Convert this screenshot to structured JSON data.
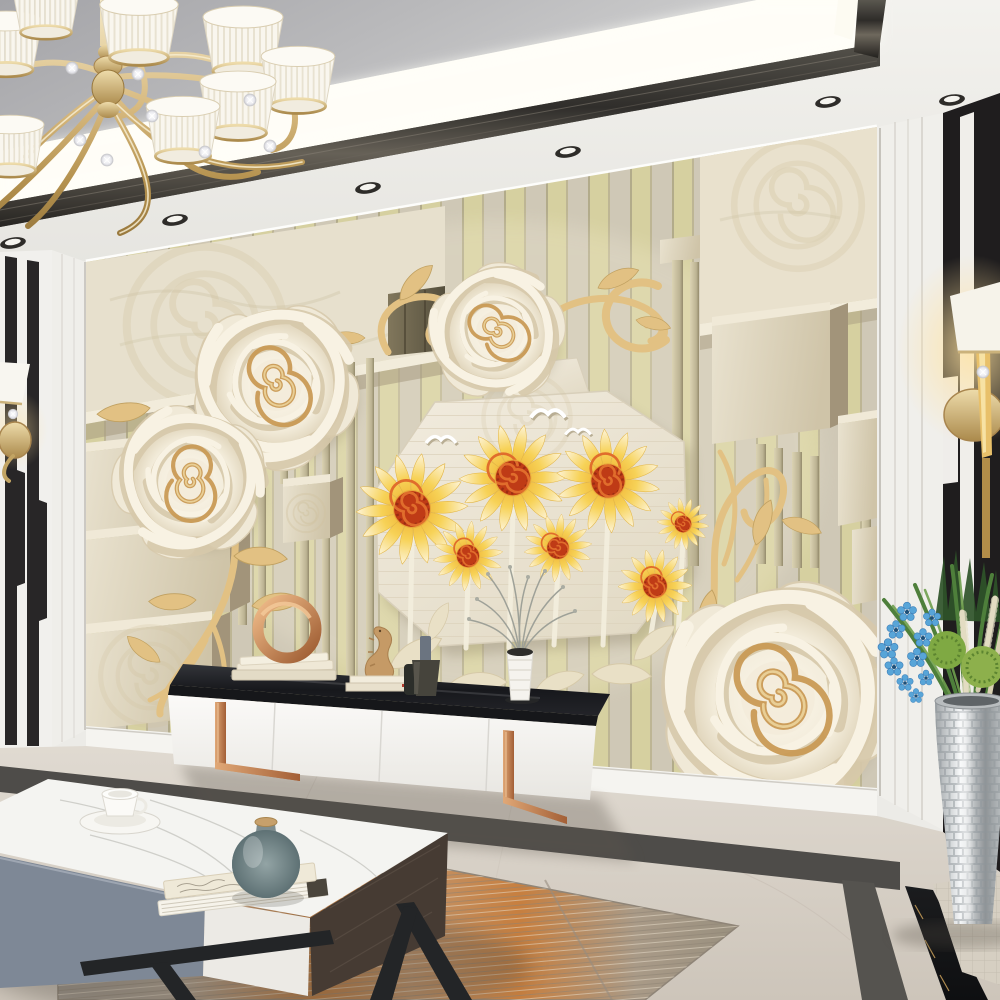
{
  "image": {
    "type": "interior-render",
    "subject": "Modern living room with 3D rose and sunflower embossed mural feature wall",
    "width_px": 1000,
    "height_px": 1000
  },
  "colors": {
    "ceiling_shadow": "#a7a7ab",
    "cove_white": "#fffdf7",
    "trim_dark": "#3a3835",
    "soffit": "#ecebe7",
    "wall_white": "#f2f1ed",
    "stripe_gold": "#d6d0a0",
    "stripe_beige": "#cfc8b6",
    "block_face": "#dcd2bc",
    "rose_petal": "#f4eedd",
    "rose_center": "#c99a55",
    "octagon": "#ece6d6",
    "sun_petal": "#f0b93a",
    "sun_petal_tip": "#fdf4d8",
    "sun_center": "#bf3b16",
    "sun_swirl": "#e06d2c",
    "gold_branch": "#e2c183",
    "gold_metal": "#d9bd8a",
    "black_panel": "#1f1d1e",
    "copper": "#c07f52",
    "console_white": "#f7f6f3",
    "floor_light": "#ddd7ce",
    "floor_dark": "#cfc7bc",
    "strip_gray": "#4e4c49",
    "marble_black": "#141517",
    "rug_orange": "#c07a3c",
    "rug_gray": "#a1988d",
    "table_front": "#7e8896",
    "wood_dark": "#463b33",
    "vase_teal": "#77898c",
    "plant_green": "#4e7f3b",
    "plant_blue": "#58a5d8",
    "silver": "#ccd0d2",
    "glow": "#ffdf9e"
  },
  "scene": {
    "ceiling": {
      "elements": [
        "recessed tray",
        "cove light band",
        "dark metal trim",
        "recessed spotlights"
      ],
      "spotlight_count": 6
    },
    "chandelier": {
      "style": "gold scrolled arms with crystal balls",
      "shade_style": "white pleated cone shades with gold rims",
      "shade_count": 8
    },
    "feature_wall": {
      "frame": "white molding",
      "mural": {
        "style": "3D embossed sculptural wallpaper",
        "background": "vertical gold and beige stripes",
        "sculpted_roses": {
          "count": 4,
          "color": "cream with gold spiral hearts"
        },
        "embossed_roses": {
          "count": 5
        },
        "sunflower_panel": {
          "shape": "octagon linen panel",
          "sunflower_count": 7,
          "bird_count": 3,
          "leaf_garland": true
        },
        "gold_branches": {
          "count": 5
        },
        "geometry": "stepped 3D blocks and slats on both sides"
      }
    },
    "left_wall": {
      "pattern": "black marble and white vertical stripes",
      "sconce": "gold wall lamp with white shade"
    },
    "right_wall": {
      "pattern": "black panels with white stripes",
      "sconce": "lit gold wall lamp with white shade"
    },
    "tv_console": {
      "body": "white, 4 flat doors",
      "top": "black marble slab",
      "legs": "copper flat bars",
      "decor": [
        "copper ring sculpture on stacked books",
        "carved wood seahorse figurine",
        "small book stack",
        "dark bottle pair",
        "white ribbed vase with dried gray sprigs"
      ]
    },
    "coffee_table": {
      "top": "white marble slab",
      "front": "gray-blue drawer and white drawer",
      "side": "dark wood panel",
      "legs": "black angular metal",
      "items": [
        "white teacup on saucer",
        "two stacked books",
        "teal round vase with cork lid"
      ]
    },
    "floor": {
      "material": "beige polished marble",
      "borders": [
        "dark gray strip",
        "black marble strip with gold veins"
      ],
      "accent": "beige mosaic tile patch"
    },
    "rug": {
      "style": "abstract streaked",
      "colors": [
        "gray",
        "orange",
        "cream"
      ]
    },
    "plant": {
      "container": "silver mosaic floor vase",
      "contents": [
        "green blades",
        "round green cactus balls",
        "blue orchid sprays",
        "cream fronds",
        "dark spiky leaves"
      ]
    }
  }
}
